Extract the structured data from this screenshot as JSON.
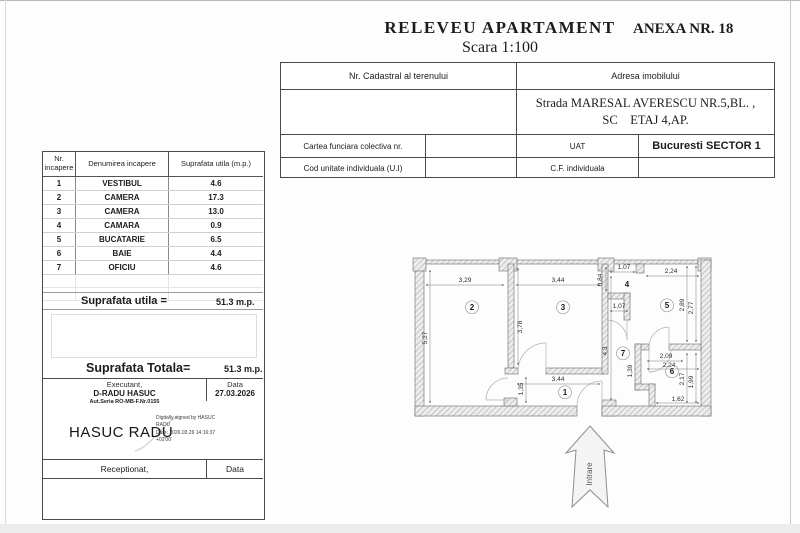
{
  "page": {
    "title": "RELEVEU  APARTAMENT",
    "scale": "Scara 1:100",
    "annex": "ANEXA NR. 18"
  },
  "info_table": {
    "cadastral_header": "Nr. Cadastral al terenului",
    "address_header": "Adresa imobilului",
    "address_line1": "Strada MARESAL AVERESCU NR.5,BL.  ,",
    "address_line2": "SC    ETAJ 4,AP.",
    "land_book_label": "Cartea funciara colectiva nr.",
    "uat_label": "UAT",
    "uat_value": "Bucuresti SECTOR 1",
    "unit_code_label": "Cod unitate individuala (U.I)",
    "cf_label": "C.F. individuala"
  },
  "room_table": {
    "header_nr_line1": "Nr.",
    "header_nr_line2": "incapere",
    "header_name": "Denumirea  incapere",
    "header_area": "Suprafata utila   (m.p.)",
    "rows": [
      {
        "nr": "1",
        "name": "VESTIBUL",
        "area": "4.6"
      },
      {
        "nr": "2",
        "name": "CAMERA",
        "area": "17.3"
      },
      {
        "nr": "3",
        "name": "CAMERA",
        "area": "13.0"
      },
      {
        "nr": "4",
        "name": "CAMARA",
        "area": "0.9"
      },
      {
        "nr": "5",
        "name": "BUCATARIE",
        "area": "6.5"
      },
      {
        "nr": "6",
        "name": "BAIE",
        "area": "4.4"
      },
      {
        "nr": "7",
        "name": "OFICIU",
        "area": "4.6"
      }
    ],
    "useful_label": "Suprafata utila =",
    "useful_value": "51.3 m.p.",
    "total_label": "Suprafata Totala=",
    "total_value": "51.3 m.p."
  },
  "certification": {
    "executant_label": "Executant,",
    "executant_name": "D-RADU HASUC",
    "executant_authorization": "Aut.Seria RO-MB-F.Nr.0155",
    "date_label": "Data",
    "date_value": "27.03.2026",
    "signature_name": "HASUC RADU",
    "signature_details_line1": "Digitally signed by HASUC",
    "signature_details_line2": "RADU",
    "signature_details_line3": "Date: 2026.03.26 14:16:37",
    "signature_details_line4": "+02'00'",
    "received_label": "Receptionat,",
    "received_date_label": "Data"
  },
  "floorplan": {
    "entrance_label": "Intrare",
    "rooms": [
      {
        "n": "1",
        "x": 167,
        "y": 145,
        "c": 1
      },
      {
        "n": "2",
        "x": 74,
        "y": 60,
        "c": 1
      },
      {
        "n": "3",
        "x": 165,
        "y": 60,
        "c": 1
      },
      {
        "n": "4",
        "x": 229,
        "y": 37,
        "c": 0
      },
      {
        "n": "5",
        "x": 269,
        "y": 58,
        "c": 1
      },
      {
        "n": "6",
        "x": 274,
        "y": 124,
        "c": 1
      },
      {
        "n": "7",
        "x": 225,
        "y": 106,
        "c": 1
      }
    ],
    "dimensions": [
      {
        "t": "3,29",
        "x": 67,
        "y": 32
      },
      {
        "t": "3,44",
        "x": 160,
        "y": 32
      },
      {
        "t": "1,07",
        "x": 226,
        "y": 19
      },
      {
        "t": "2,24",
        "x": 273,
        "y": 23
      },
      {
        "t": "0,84",
        "x": 204,
        "y": 30,
        "r": -90
      },
      {
        "t": "5,27",
        "x": 29,
        "y": 88,
        "r": -90
      },
      {
        "t": "3,78",
        "x": 124,
        "y": 77,
        "r": -90
      },
      {
        "t": "1,07",
        "x": 221,
        "y": 58
      },
      {
        "t": "2,89",
        "x": 286,
        "y": 55,
        "r": -90
      },
      {
        "t": "2,77",
        "x": 295,
        "y": 58,
        "r": -90
      },
      {
        "t": "4,3",
        "x": 209,
        "y": 101,
        "r": -90
      },
      {
        "t": "2,09",
        "x": 268,
        "y": 108
      },
      {
        "t": "2,24",
        "x": 271,
        "y": 117
      },
      {
        "t": "1,39",
        "x": 234,
        "y": 121,
        "r": -90
      },
      {
        "t": "2,17",
        "x": 286,
        "y": 129,
        "r": -90
      },
      {
        "t": "1,99",
        "x": 295,
        "y": 132,
        "r": -90
      },
      {
        "t": "1,62",
        "x": 280,
        "y": 151
      },
      {
        "t": "3,44",
        "x": 160,
        "y": 131
      },
      {
        "t": "1,35",
        "x": 125,
        "y": 139,
        "r": -90
      }
    ]
  }
}
